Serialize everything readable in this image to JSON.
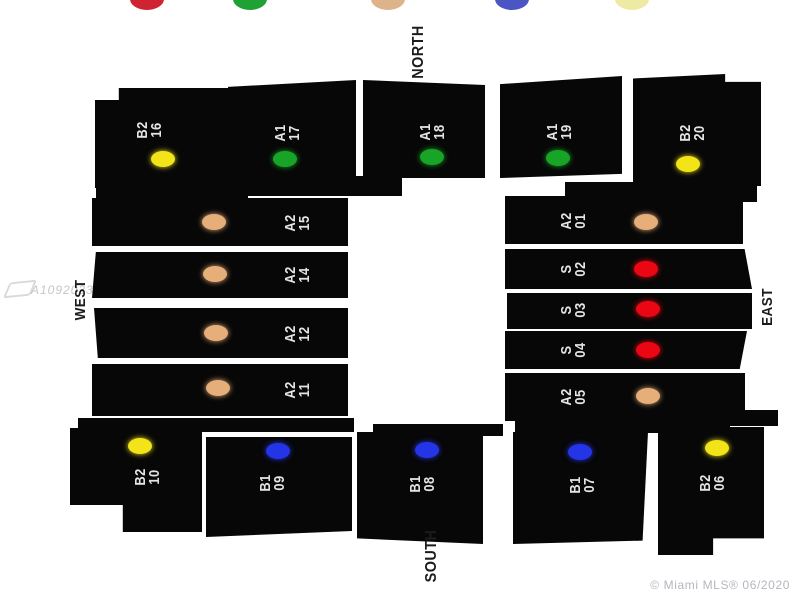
{
  "compass": {
    "north": "NORTH",
    "south": "SOUTH",
    "west": "WEST",
    "east": "EAST"
  },
  "legend_dots": [
    {
      "name": "red",
      "color": "#d02331"
    },
    {
      "name": "green",
      "color": "#1da233"
    },
    {
      "name": "tan",
      "color": "#ddb38c"
    },
    {
      "name": "blue",
      "color": "#4c55c4"
    },
    {
      "name": "yellow",
      "color": "#eeeaa4"
    }
  ],
  "type_colors": {
    "A1": "#18a527",
    "A2": "#e6ae78",
    "B1": "#2335e6",
    "B2": "#f2e418",
    "S": "#ea0613"
  },
  "units": [
    {
      "id": "16",
      "type": "B2",
      "number": "16"
    },
    {
      "id": "17",
      "type": "A1",
      "number": "17"
    },
    {
      "id": "18",
      "type": "A1",
      "number": "18"
    },
    {
      "id": "19",
      "type": "A1",
      "number": "19"
    },
    {
      "id": "20",
      "type": "B2",
      "number": "20"
    },
    {
      "id": "15",
      "type": "A2",
      "number": "15"
    },
    {
      "id": "14",
      "type": "A2",
      "number": "14"
    },
    {
      "id": "12",
      "type": "A2",
      "number": "12"
    },
    {
      "id": "11",
      "type": "A2",
      "number": "11"
    },
    {
      "id": "01",
      "type": "A2",
      "number": "01"
    },
    {
      "id": "02",
      "type": "S",
      "number": "02"
    },
    {
      "id": "03",
      "type": "S",
      "number": "03"
    },
    {
      "id": "04",
      "type": "S",
      "number": "04"
    },
    {
      "id": "05",
      "type": "A2",
      "number": "05"
    },
    {
      "id": "10",
      "type": "B2",
      "number": "10"
    },
    {
      "id": "09",
      "type": "B1",
      "number": "09"
    },
    {
      "id": "08",
      "type": "B1",
      "number": "08"
    },
    {
      "id": "07",
      "type": "B1",
      "number": "07"
    },
    {
      "id": "06",
      "type": "B2",
      "number": "06"
    }
  ],
  "watermarks": {
    "listing_id": "A1092033",
    "copyright": "© Miami MLS® 06/2020"
  }
}
